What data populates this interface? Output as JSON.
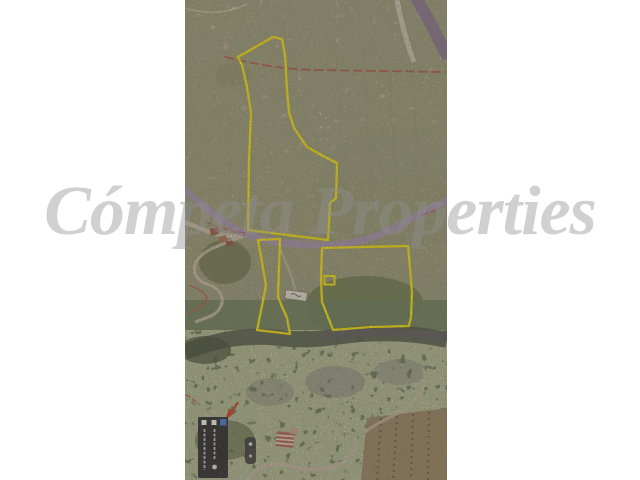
{
  "page": {
    "width": 640,
    "height": 480,
    "background": "#ffffff"
  },
  "watermark": {
    "text": "Cómpeta Properties",
    "color_hex": "#d1d1d1"
  },
  "aerial_map": {
    "kind": "satellite-photo-with-plot-boundaries",
    "boundary_color": "#ffeb00",
    "road_overlay_color": "#a98fc6",
    "cadastral_line_color": "#b5493a",
    "marker_color": "#c8372a",
    "plots": [
      {
        "id": "plot-north",
        "points": "88,37 97,39 100,55 102,90 104,112 109,128 122,147 140,157 152,163 151,198 145,203 143,240 63,230 64,160 66,113 62,87 57,65 53,57"
      },
      {
        "id": "plot-middle-strip",
        "points": "73,240 95,239 93,297 102,318 105,334 72,330 78,301 81,285"
      },
      {
        "id": "plot-southeast",
        "points": "137,248 178,247 223,246 225,268 227,293 226,317 224,326 185,327 148,330 145,322 137,302 136,278"
      }
    ],
    "inner_structure": {
      "x": 139.5,
      "y": 276,
      "width": 10,
      "height": 8.5
    },
    "legend": {
      "background": "#10131f",
      "checkbox_color": "#ffffff",
      "layers_icon_color": "#3c6fd6"
    },
    "icons": {
      "legend_checkboxes": "checkbox-icon",
      "legend_layers": "layers-icon",
      "marker": "red-arrow-icon",
      "zoom_control": "map-control-icon"
    }
  }
}
